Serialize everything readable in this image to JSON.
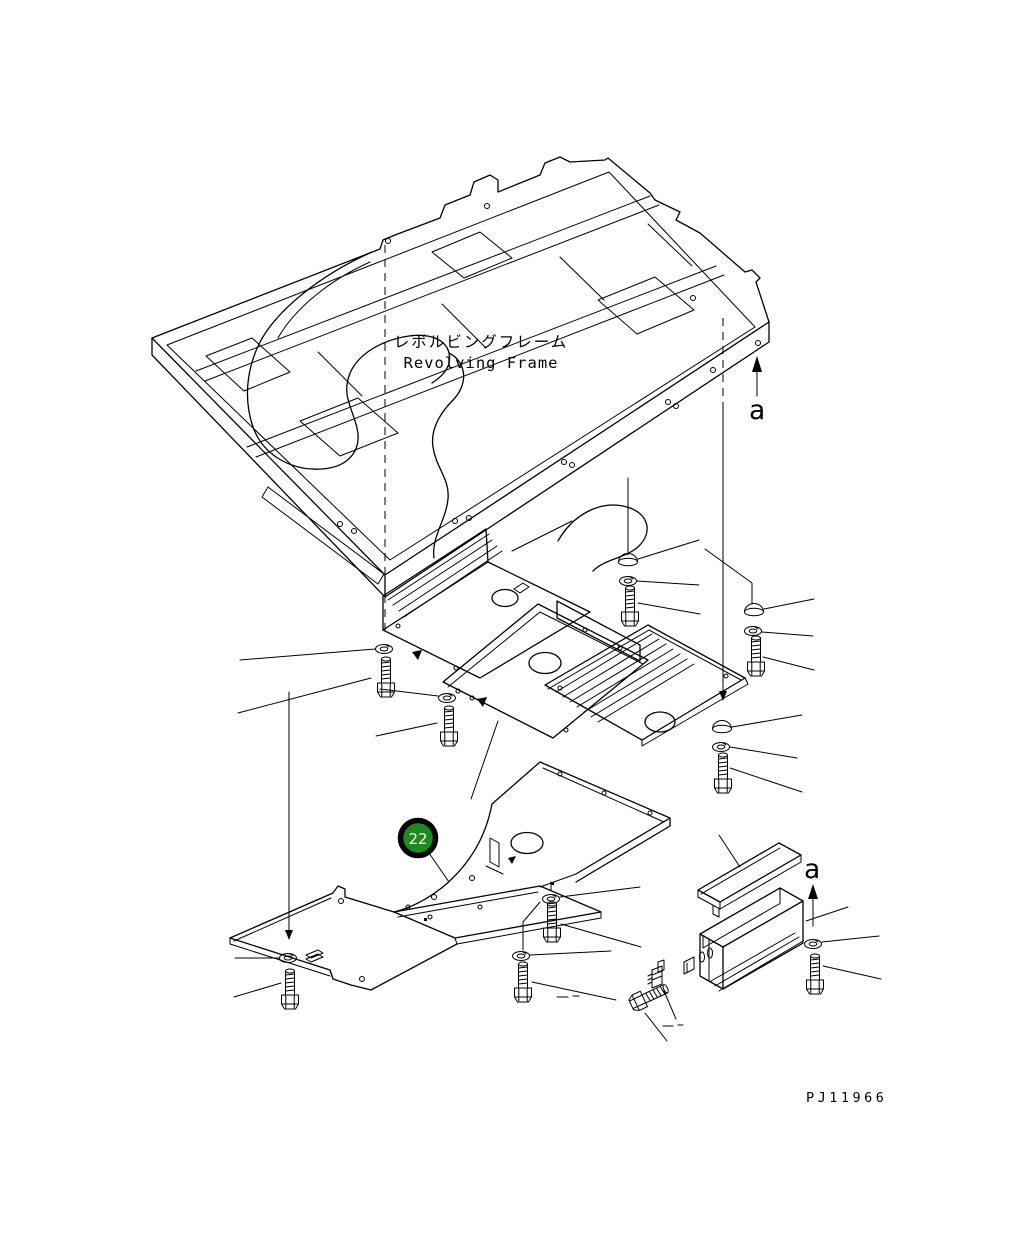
{
  "page": {
    "background": "#ffffff",
    "line_color": "#000000"
  },
  "frame_label": {
    "jp": "レボルビングフレーム",
    "en": "Revolving Frame"
  },
  "callout": {
    "number": "22",
    "fill": "#1e8a1e",
    "ring": "#000000",
    "text_color": "#ffffff"
  },
  "section_arrows": {
    "top": "a",
    "bottom": "a"
  },
  "drawing_number": "PJ11966"
}
